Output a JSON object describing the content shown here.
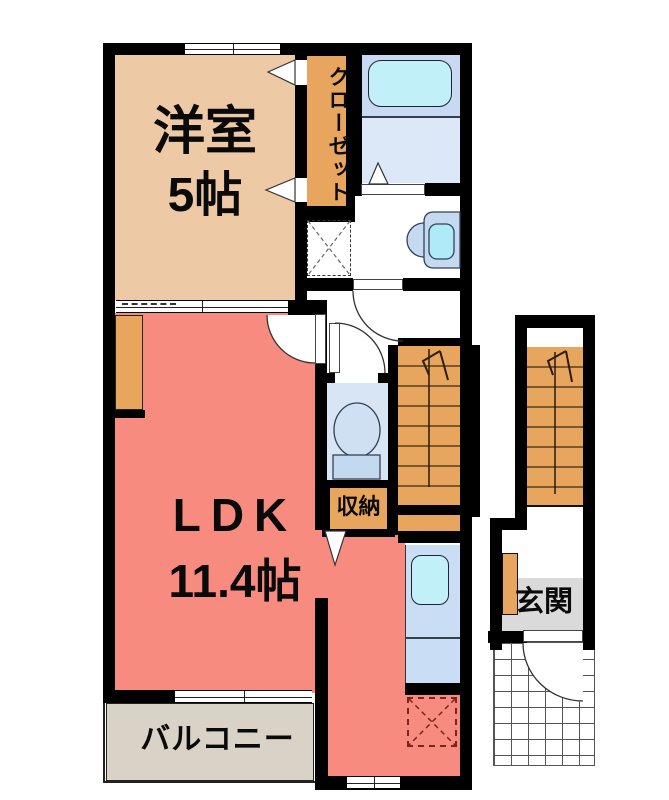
{
  "rooms": {
    "western": {
      "name": "洋室",
      "size": "5帖"
    },
    "closet": {
      "label": "クローゼット"
    },
    "ldk": {
      "name": "LDK",
      "size": "11.4帖"
    },
    "storage": {
      "label": "収納"
    },
    "balcony": {
      "label": "バルコニー"
    },
    "entrance": {
      "label": "玄関"
    }
  },
  "colors": {
    "wall": "#000000",
    "western_room": "#eec9a5",
    "closet_orange": "#e7a55e",
    "ldk_salmon": "#f78b80",
    "balcony_gray": "#d8d2c7",
    "entrance_gray": "#dadada",
    "bath_blue": "#c8daf2",
    "bath_lower_blue": "#dce8f7",
    "toilet_blue": "#d7e5f5",
    "counter_blue": "#c9def4",
    "water_cyan": "#c2f0f9",
    "basin_blue": "#c5daf1",
    "fridge_dash_red": "#7b241c"
  }
}
